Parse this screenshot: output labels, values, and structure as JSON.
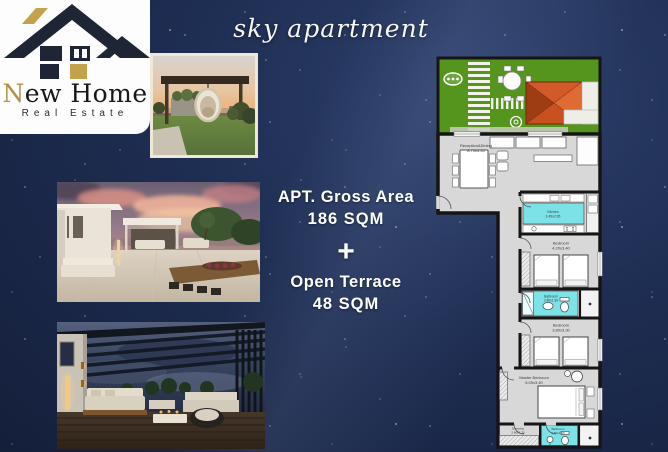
{
  "title": "sky apartment",
  "logo": {
    "brand_initial": "N",
    "brand_rest": "ew Home",
    "tagline": "Real Estate",
    "colors": {
      "dark": "#1e2534",
      "gold": "#c2a24c"
    }
  },
  "summary": {
    "gross_label": "APT. Gross Area",
    "gross_value": "186 SQM",
    "plus": "+",
    "terrace_label": "Open Terrace",
    "terrace_value": "48 SQM"
  },
  "photos": [
    {
      "name": "sunset-pergola-terrace-photo"
    },
    {
      "name": "dusk-open-terrace-photo"
    },
    {
      "name": "night-lounge-terrace-photo"
    }
  ],
  "floor_plan": {
    "rooms": [
      {
        "label": "Reception&Dining",
        "dims": "8.75x5.45"
      },
      {
        "label": "Kitchen",
        "dims": "3.45x2.95"
      },
      {
        "label": "Bedroom",
        "dims": "4.20x3.40"
      },
      {
        "label": "Bathroom",
        "dims": "2.80x1.80"
      },
      {
        "label": "Bedroom",
        "dims": "3.80x3.30"
      },
      {
        "label": "Master Bedroom",
        "dims": "5.00x3.40"
      },
      {
        "label": "Dressing",
        "dims": "2.80x1.30"
      },
      {
        "label": "Bathroom",
        "dims": "1.80x1.60"
      }
    ],
    "colors": {
      "garden": "#55941d",
      "floor": "#d8d8d8",
      "wet": "#7ce2e8",
      "roof": "#c8511f",
      "wall": "#151515",
      "night_sky": "#1e2d52"
    }
  }
}
